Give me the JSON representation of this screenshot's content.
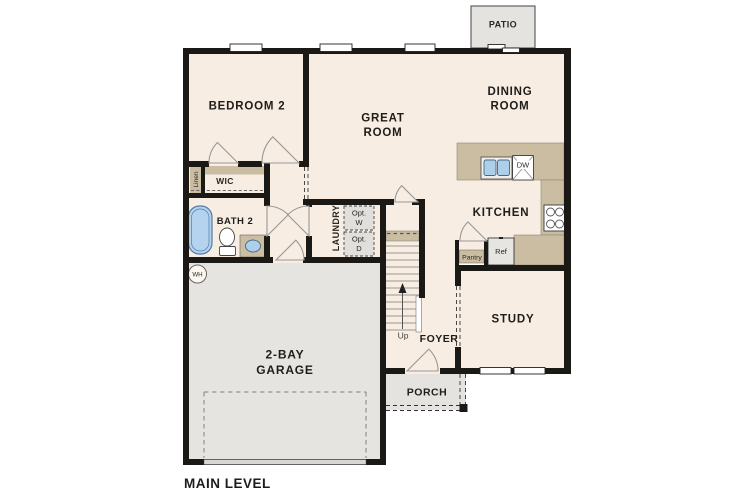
{
  "plan_title": "MAIN LEVEL",
  "labels": {
    "patio": "PATIO",
    "bedroom2": "BEDROOM 2",
    "great_room_1": "GREAT",
    "great_room_2": "ROOM",
    "dining_1": "DINING",
    "dining_2": "ROOM",
    "kitchen": "KITCHEN",
    "study": "STUDY",
    "foyer": "FOYER",
    "porch": "PORCH",
    "garage_1": "2-BAY",
    "garage_2": "GARAGE",
    "bath2": "BATH 2",
    "wic": "WIC",
    "linen": "Linen",
    "laundry": "LAUNDRY",
    "opt_w_1": "Opt.",
    "opt_w_2": "W",
    "opt_d_1": "Opt.",
    "opt_d_2": "D",
    "dw": "DW",
    "ref": "Ref",
    "pantry": "Pantry",
    "up": "Up",
    "wh": "WH",
    "main_level": "MAIN LEVEL"
  },
  "colors": {
    "floor": "#f7ede2",
    "wall": "#1b1916",
    "counter_tan": "#cabda2",
    "garage_floor": "#e6e4e1",
    "patio_porch_grey": "#e4e3e0",
    "appliance_grey": "#e7e5e2",
    "fixture_blue": "#aecfea",
    "text": "#1f1d1a"
  },
  "fixtures": [
    "bathtub",
    "toilet",
    "vanity-sink",
    "kitchen-double-sink",
    "dishwasher",
    "range-4-burner",
    "refrigerator",
    "optional-washer",
    "optional-dryer",
    "water-heater",
    "stairs-up",
    "closet-shelf",
    "garage-door",
    "front-door",
    "patio-sliding-door"
  ]
}
